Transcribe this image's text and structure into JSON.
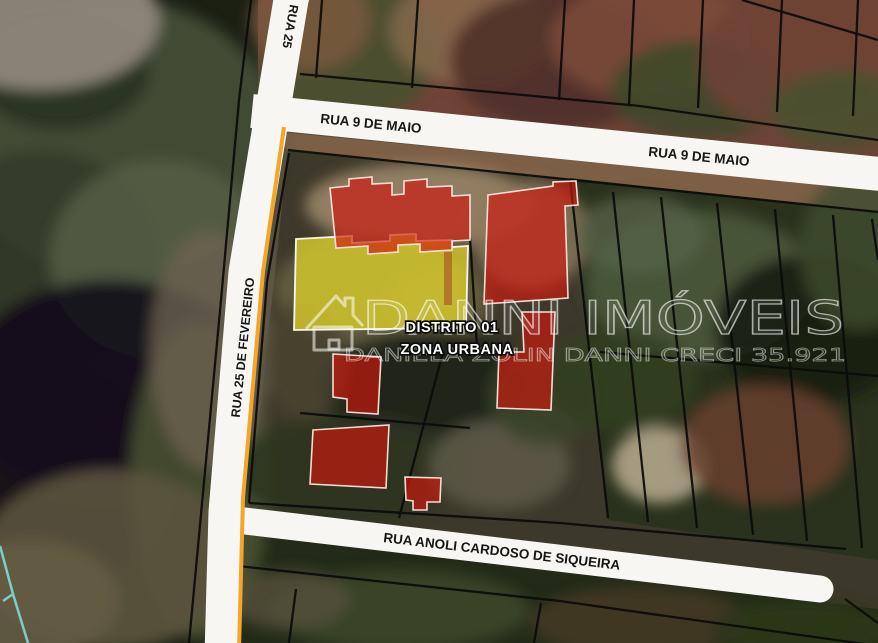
{
  "map": {
    "streets": [
      {
        "id": "rua-25-de-fevereiro-top",
        "label": "RUA 25"
      },
      {
        "id": "rua-9-de-maio-west",
        "label": "RUA  9 DE MAIO"
      },
      {
        "id": "rua-9-de-maio-east",
        "label": "RUA  9 DE MAIO"
      },
      {
        "id": "rua-25-de-fevereiro",
        "label": "RUA  25 DE FEVEREIRO"
      },
      {
        "id": "rua-anoli-cardoso-de-siqueira",
        "label": "RUA ANOLI CARDOSO DE SIQUEIRA"
      }
    ],
    "zone_labels": [
      {
        "label": "DISTRITO 01"
      },
      {
        "label": "ZONA URBANA"
      }
    ],
    "watermark": {
      "brand": "DANNI IMÓVEIS",
      "credit": "DANIELA ZOLIN DANNI  CRECI 35.921",
      "logo_icon": "house-outline-icon"
    },
    "highlights": {
      "building_footprints": 6,
      "highlighted_lot": 1
    },
    "colors": {
      "building_highlight_red": "#ce180e",
      "lot_highlight_yellow": "#d5c92c",
      "street_band_white": "#f8f6f2",
      "parcel_line_black": "#0b0b0b",
      "street_edge_orange": "#f4a62a",
      "zone_boundary_cyan": "#82dada"
    }
  }
}
